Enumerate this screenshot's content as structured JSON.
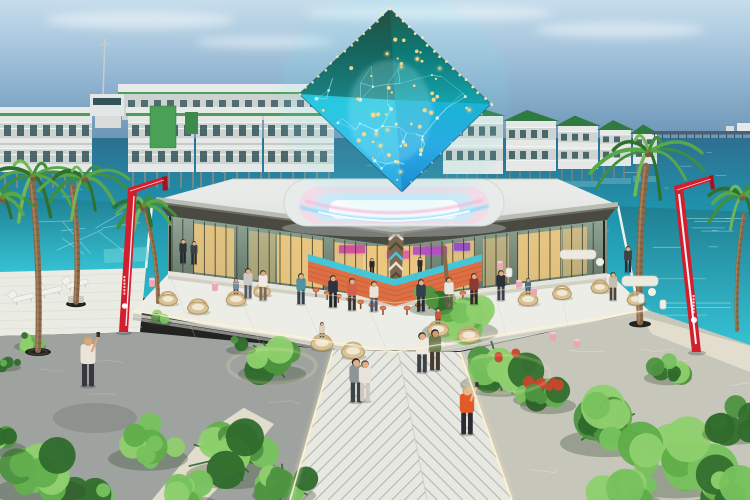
{
  "image": {
    "type": "3d-architectural-render",
    "subject": "Floating resort plaza with a glowing faceted crystal sculpture hovering above an open-air bar pavilion",
    "environment": "Turquoise lagoon, overwater villas with green roofs, palm trees, tropical garden beds, chevron-plank boardwalk",
    "sky": "Hazy blue daytime sky with thin high clouds",
    "landmark_lighting": [
      "gold micro string-lights",
      "cyan wireframe mesh",
      "pink and blue neon podium ring"
    ],
    "counts": {
      "red_sign_pillars": 2,
      "palm_trees": 6,
      "villas_left": 4,
      "villas_right": 5,
      "people_approx": 26,
      "bar_stools": 14,
      "wicker_chairs": 12
    }
  },
  "palette": {
    "sky_top": "#c6ddec",
    "sky_mid": "#8fb3d0",
    "sky_horizon": "#5e88aa",
    "ocean_deep": "#2e6f90",
    "ocean_teal": "#2cb6c6",
    "pool": "#35c2d4",
    "villa_white": "#e5e8e6",
    "villa_wall_shade": "#ccd3d0",
    "villa_green": "#4aa055",
    "villa_roof_green": "#2e7a40",
    "villa_glass": "#33535a",
    "pier_dark": "#4b6172",
    "roof_light": "#e9ebe8",
    "roof_fascia": "#b9bcb4",
    "eave_shadow": "#4a4a42",
    "glass_dark": "#5a6c5e",
    "interior_glow": "#f6cd80",
    "sign_magenta": "#cf4f9e",
    "sign_purple": "#b44fc4",
    "bar_coral": "#dd6f44",
    "bar_coral_dark": "#c05531",
    "bar_teal": "#45c6d8",
    "column_brown": "#7c6750",
    "podium_white": "#e7ebea",
    "neon_pink": "#f6b8d8",
    "neon_blue": "#8fdcf8",
    "crystal_dark": "#134f46",
    "crystal_teal": "#17bfd4",
    "crystal_blue": "#1b82cf",
    "crystal_gold": "#ffd887",
    "terrace_light": "#ecede7",
    "deck_light": "#e7e8e2",
    "deck_step": "#c6c8c0",
    "stone_gray": "#9fa39f",
    "stone_warm": "#c7c6bb",
    "sand": "#e6dfcf",
    "walk_stripe": "#aaada7",
    "light_warm": "#ffedbe",
    "garden_green": "#4e9440",
    "garden_bright": "#77c25e",
    "garden_dark": "#2f6b2c",
    "plant_red": "#c6472e",
    "palm_trunk": "#8a6a4a",
    "wicker": "#d9c294",
    "sofa_white": "#eceade",
    "stool_pink": "#e8a8b6",
    "grate_black": "#23231f",
    "signage_red": "#d21f2e",
    "signage_red_dark": "#a8121f",
    "skin": "#e2ae85"
  }
}
